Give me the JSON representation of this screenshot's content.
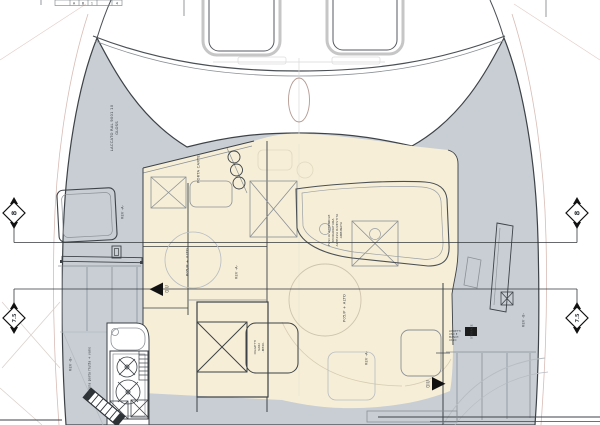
{
  "drawing": {
    "labels": {
      "section_8": "8",
      "section_75": "7.5",
      "laccato_1": "LACCATO RAL 9001 10",
      "laccato_2": "GLOSS",
      "porta_carte": "PORTA CARTE",
      "pos_alto": "P05/P + ALTO",
      "rev_a": "REV -A-",
      "rev_b": "REV -B-",
      "giu": "GIU",
      "fascia": [
        "FASCIA APPENDILE",
        "MODANATURA",
        "ALTEZZA RIVESTITA",
        "ABBINATA"
      ],
      "oggetti": [
        "OGGETTI",
        "VARI",
        "-MEDI-"
      ],
      "mensola": "mensola porta frutta + vano",
      "storage": "STORAGE",
      "note_right": [
        "LIBRETTI",
        "USO E",
        "MANUT.",
        "VANO"
      ],
      "titleblock": [
        "A",
        "B",
        "1",
        "4"
      ]
    },
    "colors": {
      "deck_gray": "#c8ced4",
      "galley_beige": "#f6eed7",
      "line_dark": "#3c4247",
      "line_mid": "#8a9096",
      "line_light": "#b6bcc2",
      "outboard_pink": "#d8bcb5",
      "arrow_black": "#111111"
    }
  }
}
